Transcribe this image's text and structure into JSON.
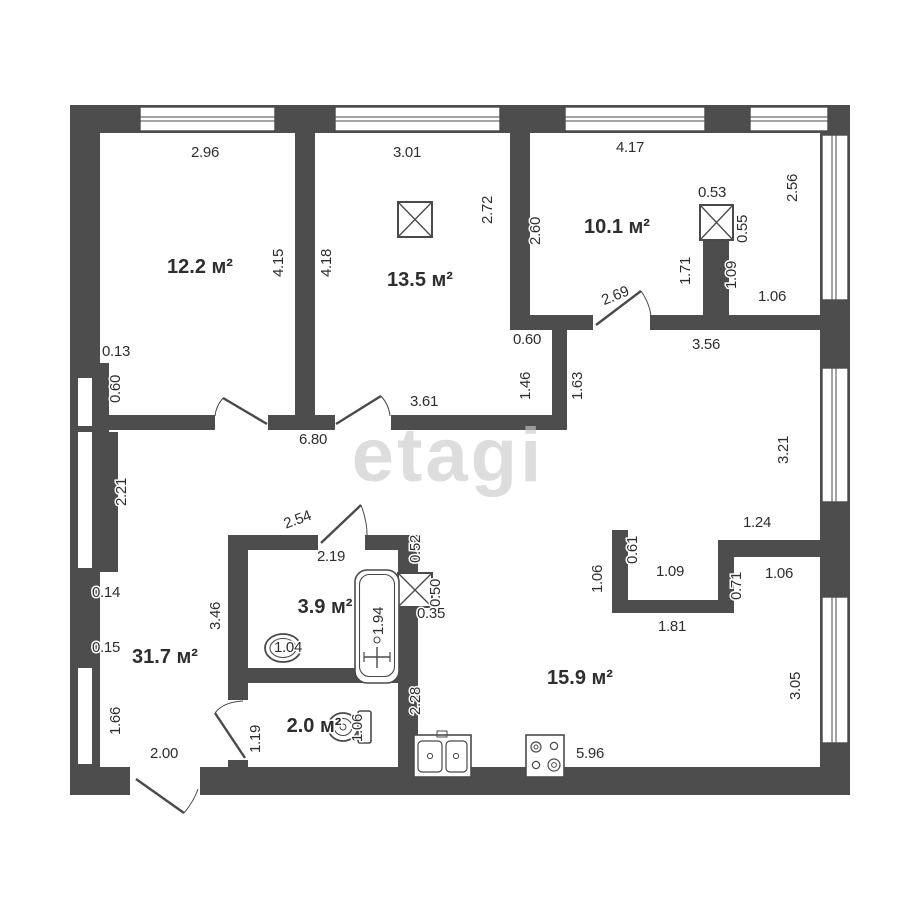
{
  "palette": {
    "wall": "#4d4d4d",
    "line": "#4a4a4a",
    "text": "#2e2e2e",
    "watermark": "#c9c9c9"
  },
  "watermark": {
    "text": "etagi"
  },
  "plan": {
    "rooms": [
      {
        "id": "room-12-2",
        "label": "12.2 м²",
        "x": 200,
        "y": 273
      },
      {
        "id": "room-13-5",
        "label": "13.5 м²",
        "x": 420,
        "y": 286
      },
      {
        "id": "room-10-1",
        "label": "10.1 м²",
        "x": 617,
        "y": 233
      },
      {
        "id": "room-31-7",
        "label": "31.7 м²",
        "x": 165,
        "y": 663
      },
      {
        "id": "room-3-9",
        "label": "3.9 м²",
        "x": 325,
        "y": 613
      },
      {
        "id": "room-2-0",
        "label": "2.0 м²",
        "x": 314,
        "y": 732
      },
      {
        "id": "room-15-9",
        "label": "15.9 м²",
        "x": 580,
        "y": 684
      }
    ],
    "dimensions": [
      {
        "t": "2.96",
        "x": 205,
        "y": 157,
        "r": 0
      },
      {
        "t": "3.01",
        "x": 407,
        "y": 157,
        "r": 0
      },
      {
        "t": "4.17",
        "x": 630,
        "y": 152,
        "r": 0
      },
      {
        "t": "0.13",
        "x": 116,
        "y": 356,
        "r": 0
      },
      {
        "t": "0.60",
        "x": 527,
        "y": 344,
        "r": 0
      },
      {
        "t": "3.56",
        "x": 706,
        "y": 349,
        "r": 0
      },
      {
        "t": "1.06",
        "x": 772,
        "y": 301,
        "r": 0
      },
      {
        "t": "6.80",
        "x": 313,
        "y": 444,
        "r": 0
      },
      {
        "t": "3.61",
        "x": 424,
        "y": 406,
        "r": 0
      },
      {
        "t": "2.69",
        "x": 617,
        "y": 300,
        "r": -22
      },
      {
        "t": "2.54",
        "x": 299,
        "y": 524,
        "r": -20
      },
      {
        "t": "2.19",
        "x": 331,
        "y": 561,
        "r": 0
      },
      {
        "t": "1.24",
        "x": 757,
        "y": 527,
        "r": 0
      },
      {
        "t": "1.09",
        "x": 670,
        "y": 576,
        "r": 0
      },
      {
        "t": "1.06",
        "x": 779,
        "y": 578,
        "r": 0
      },
      {
        "t": "1.81",
        "x": 672,
        "y": 631,
        "r": 0
      },
      {
        "t": "0.35",
        "x": 431,
        "y": 618,
        "r": 0
      },
      {
        "t": "5.96",
        "x": 590,
        "y": 758,
        "r": 0
      },
      {
        "t": "2.00",
        "x": 164,
        "y": 758,
        "r": 0
      },
      {
        "t": "0.14",
        "x": 106,
        "y": 597,
        "r": 0
      },
      {
        "t": "0.15",
        "x": 106,
        "y": 652,
        "r": 0
      },
      {
        "t": "0.53",
        "x": 712,
        "y": 197,
        "r": 0
      },
      {
        "t": "1.04",
        "x": 288,
        "y": 652,
        "r": 0
      },
      {
        "t": "4.15",
        "x": 283,
        "y": 263,
        "r": -90
      },
      {
        "t": "4.18",
        "x": 331,
        "y": 263,
        "r": -90
      },
      {
        "t": "2.72",
        "x": 492,
        "y": 210,
        "r": -90
      },
      {
        "t": "2.60",
        "x": 540,
        "y": 231,
        "r": -90
      },
      {
        "t": "2.56",
        "x": 797,
        "y": 188,
        "r": -90
      },
      {
        "t": "0.55",
        "x": 747,
        "y": 229,
        "r": -90
      },
      {
        "t": "1.71",
        "x": 690,
        "y": 271,
        "r": -90
      },
      {
        "t": "1.09",
        "x": 736,
        "y": 275,
        "r": -90
      },
      {
        "t": "0.60",
        "x": 120,
        "y": 389,
        "r": -90
      },
      {
        "t": "2.21",
        "x": 126,
        "y": 492,
        "r": -90
      },
      {
        "t": "1.46",
        "x": 530,
        "y": 386,
        "r": -90
      },
      {
        "t": "1.63",
        "x": 582,
        "y": 386,
        "r": -90
      },
      {
        "t": "3.21",
        "x": 788,
        "y": 450,
        "r": -90
      },
      {
        "t": "1.06",
        "x": 602,
        "y": 579,
        "r": -90
      },
      {
        "t": "0.61",
        "x": 637,
        "y": 550,
        "r": -90
      },
      {
        "t": "0.71",
        "x": 741,
        "y": 586,
        "r": -90
      },
      {
        "t": "3.05",
        "x": 800,
        "y": 686,
        "r": -90
      },
      {
        "t": "1.66",
        "x": 120,
        "y": 721,
        "r": -90
      },
      {
        "t": "3.46",
        "x": 220,
        "y": 616,
        "r": -90
      },
      {
        "t": "1.19",
        "x": 260,
        "y": 739,
        "r": -90
      },
      {
        "t": "1.94",
        "x": 383,
        "y": 621,
        "r": -90
      },
      {
        "t": "1.06",
        "x": 362,
        "y": 728,
        "r": -90
      },
      {
        "t": "0.52",
        "x": 420,
        "y": 549,
        "r": -90
      },
      {
        "t": "0.50",
        "x": 440,
        "y": 593,
        "r": -90
      },
      {
        "t": "2.28",
        "x": 420,
        "y": 701,
        "r": -90
      }
    ]
  }
}
